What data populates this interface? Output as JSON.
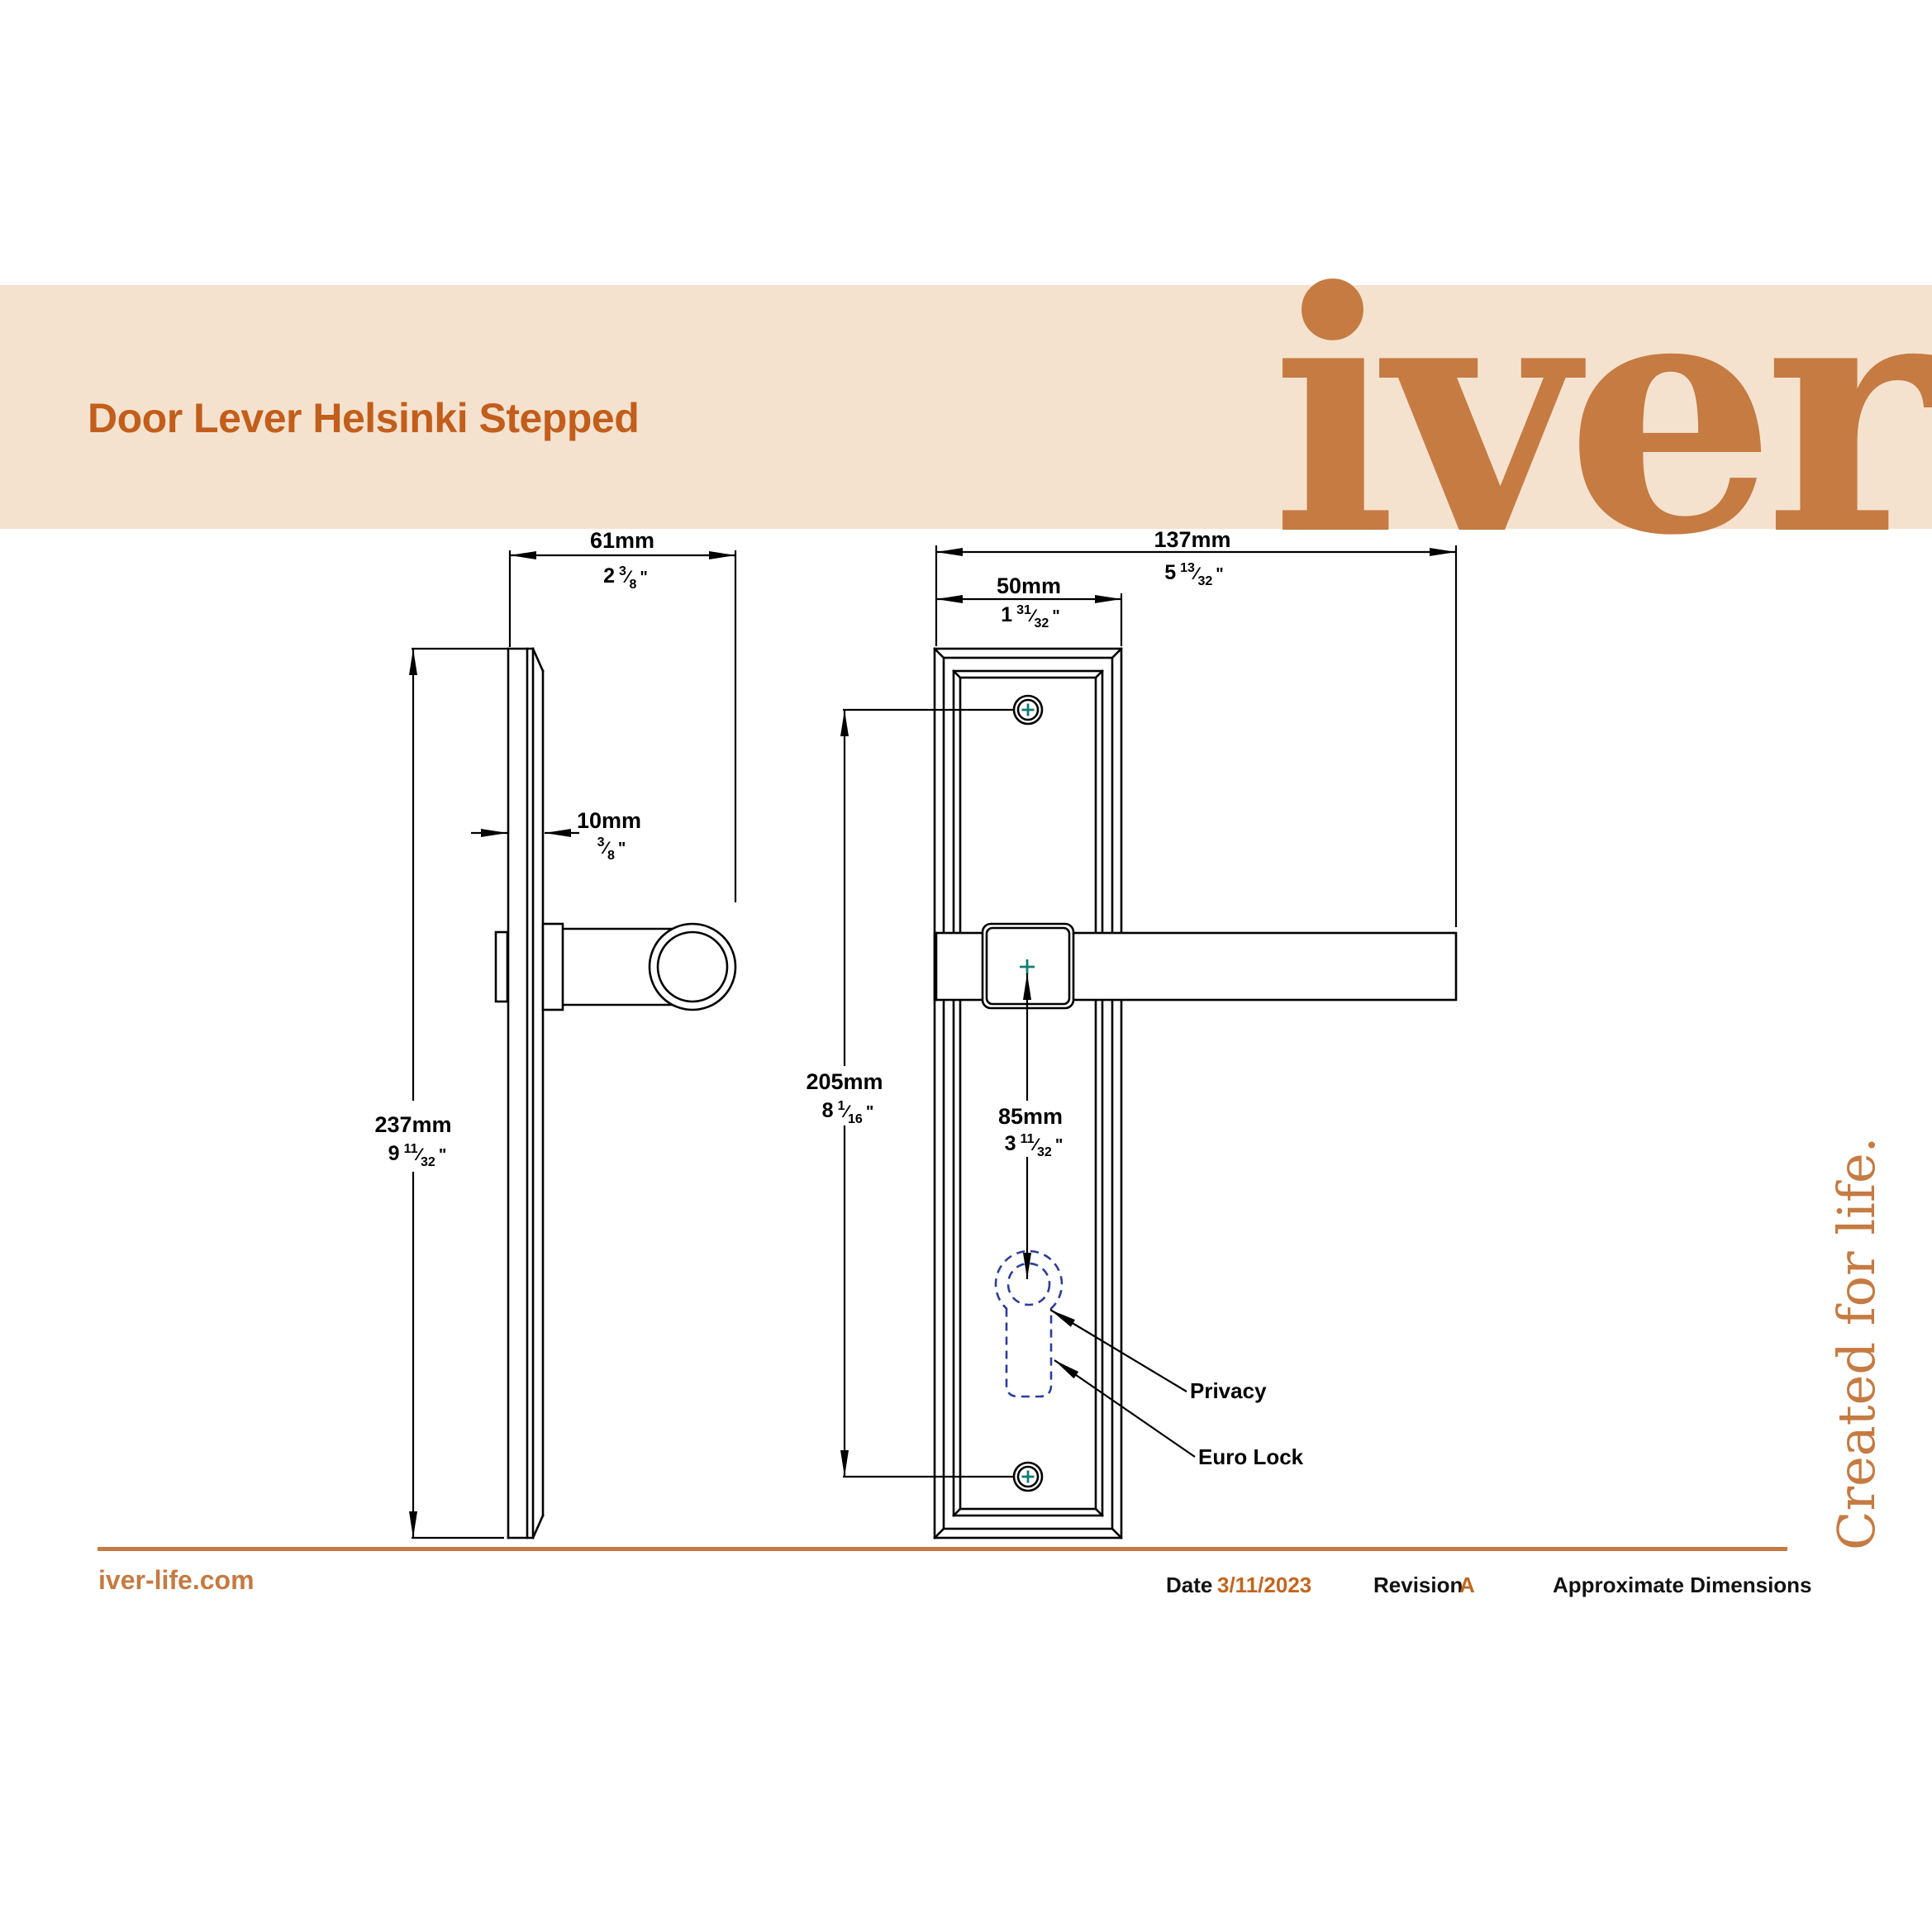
{
  "banner": {
    "title": "Door Lever Helsinki Stepped",
    "logo": "iver",
    "background": "#F5E2CE",
    "title_color": "#C25E1C",
    "logo_color": "#C57B42"
  },
  "tagline": "Created for life.",
  "drawing": {
    "line_color": "#000000",
    "screw_cross_color": "#147A74",
    "keyhole_color": "#2E3D98",
    "labels": {
      "privacy": "Privacy",
      "euro_lock": "Euro Lock"
    },
    "dimensions": {
      "projection": {
        "metric": "61mm",
        "imperial": {
          "whole": "2",
          "num": "3",
          "den": "8"
        }
      },
      "thickness": {
        "metric": "10mm",
        "imperial": {
          "whole": "",
          "num": "3",
          "den": "8"
        }
      },
      "plate_height": {
        "metric": "237mm",
        "imperial": {
          "whole": "9",
          "num": "11",
          "den": "32"
        }
      },
      "overall_length": {
        "metric": "137mm",
        "imperial": {
          "whole": "5",
          "num": "13",
          "den": "32"
        }
      },
      "plate_width": {
        "metric": "50mm",
        "imperial": {
          "whole": "1",
          "num": "31",
          "den": "32"
        }
      },
      "screw_centres": {
        "metric": "205mm",
        "imperial": {
          "whole": "8",
          "num": "1",
          "den": "16"
        }
      },
      "lever_to_keyhole": {
        "metric": "85mm",
        "imperial": {
          "whole": "3",
          "num": "11",
          "den": "32"
        }
      }
    }
  },
  "footer": {
    "website": "iver-life.com",
    "date_label": "Date",
    "date_value": "3/11/2023",
    "revision_label": "Revision",
    "revision_value": "A",
    "note": "Approximate Dimensions",
    "rule_color": "#C57B42",
    "accent_color": "#C2661F"
  }
}
